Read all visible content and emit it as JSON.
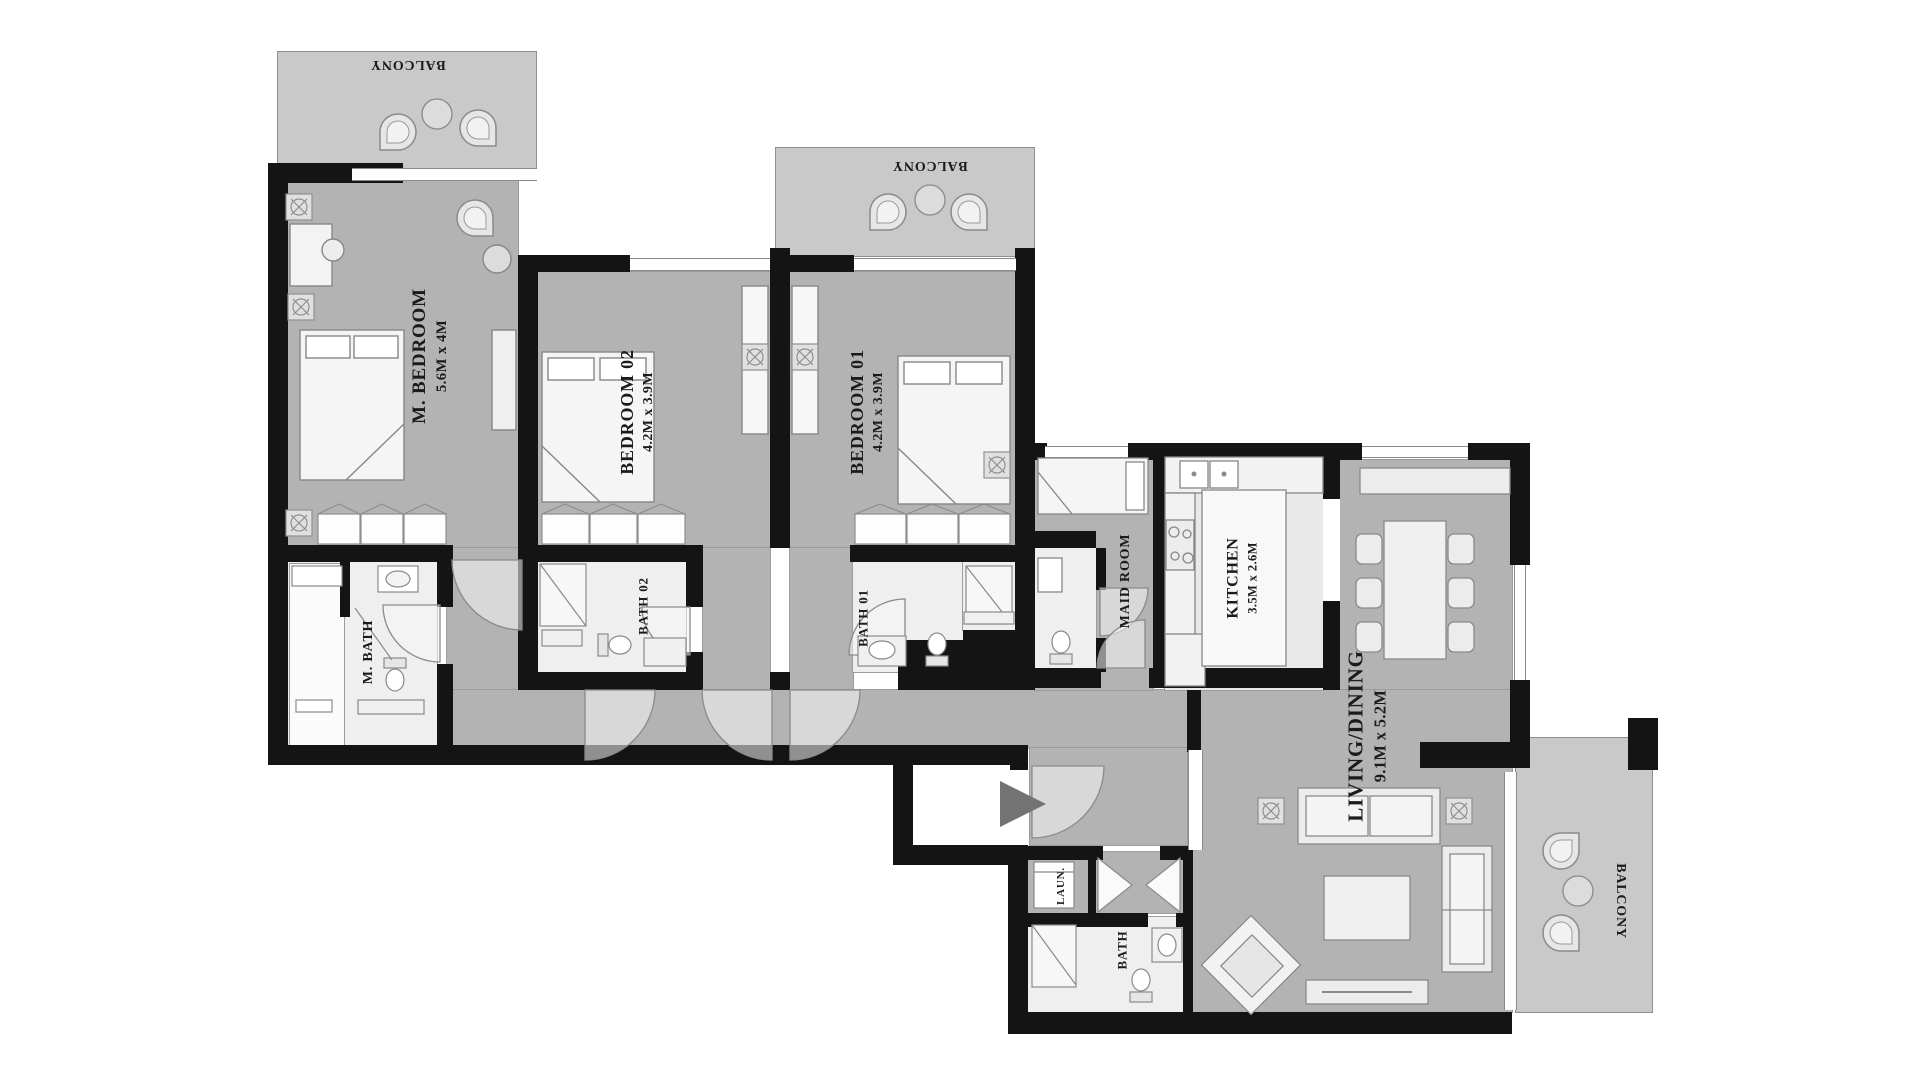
{
  "type": "apartment-floor-plan",
  "rooms": {
    "balcony_top_left": {
      "label": "BALCONY"
    },
    "master_bedroom": {
      "label": "M. BEDROOM",
      "dims": "5.6M x 4M"
    },
    "bedroom_02": {
      "label": "BEDROOM 02",
      "dims": "4.2M x 3.9M"
    },
    "balcony_top_middle": {
      "label": "BALCONY"
    },
    "bedroom_01": {
      "label": "BEDROOM 01",
      "dims": "4.2M x 3.9M"
    },
    "master_bath": {
      "label": "M. BATH"
    },
    "bath_02": {
      "label": "BATH 02"
    },
    "bath_01": {
      "label": "BATH 01"
    },
    "maid_room": {
      "label": "MAID ROOM"
    },
    "kitchen": {
      "label": "KITCHEN",
      "dims": "3.5M x 2.6M"
    },
    "living_dining": {
      "label": "LIVING/DINING",
      "dims": "9.1M x 5.2M"
    },
    "laundry": {
      "label": "LAUN."
    },
    "bath": {
      "label": "BATH"
    },
    "balcony_right": {
      "label": "BALCONY"
    }
  },
  "colors": {
    "wall": "#141414",
    "room_floor": "#b3b3b3",
    "balcony_floor": "#c9c9c9",
    "bath_floor": "#efefef",
    "furniture_fill": "#ececec",
    "furniture_stroke": "#8a8a8a",
    "label_text": "#1b1b1b",
    "entry_arrow": "#737373"
  }
}
